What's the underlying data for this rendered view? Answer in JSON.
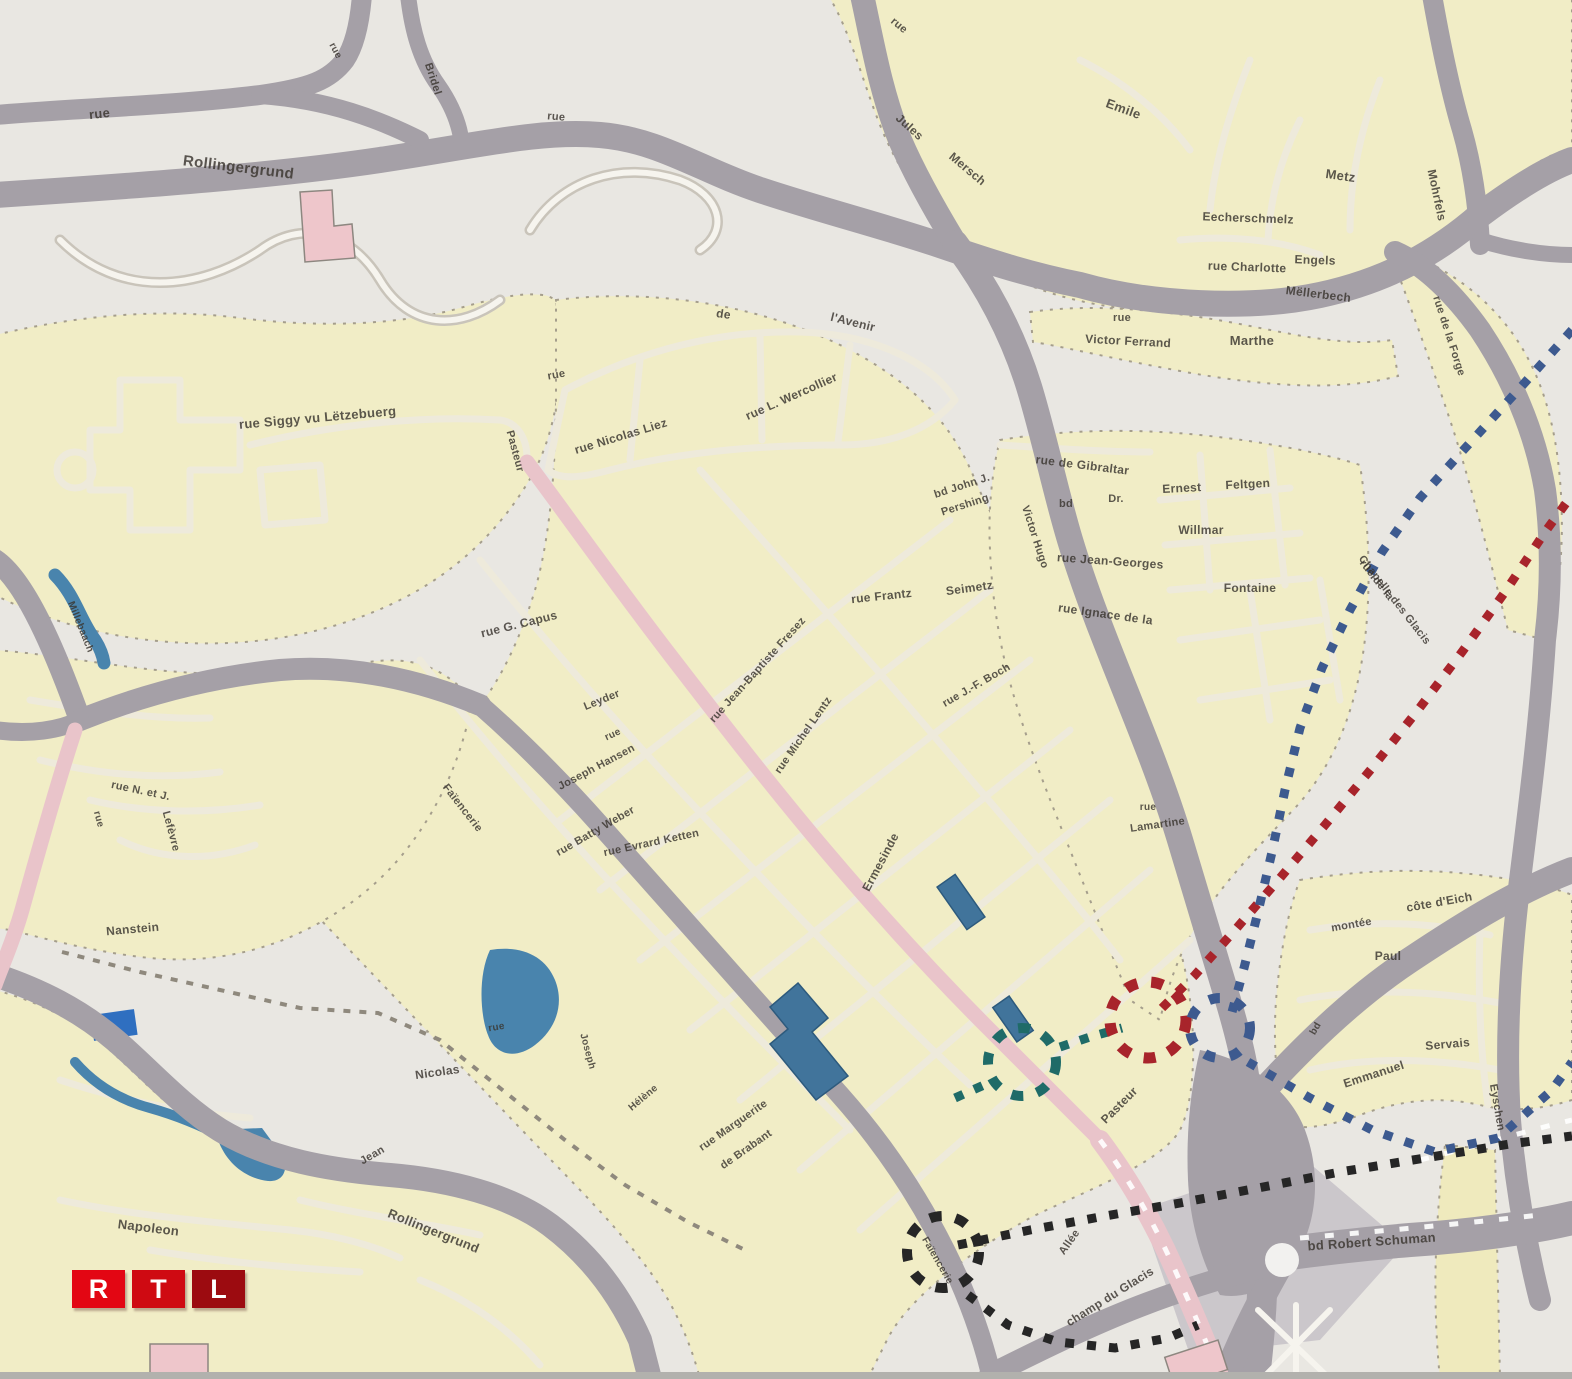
{
  "logo": {
    "letters": [
      "R",
      "T",
      "L"
    ],
    "colors": [
      "#e30613",
      "#cf0a12",
      "#9c0b10"
    ]
  },
  "palette": {
    "background": "#e9e7e2",
    "built_up": "#f1edc6",
    "gray_road": "#a5a0a7",
    "main_road_pink": "#e9c4ca",
    "water": "#4984ad",
    "glacis": "#cbc7cb",
    "route_red": "#a8242b",
    "route_blue": "#3d5a8f",
    "route_teal": "#1f6b68",
    "route_black": "#262626"
  },
  "map_labels": [
    {
      "text": "rue",
      "x": 100,
      "y": 118,
      "rot": -6,
      "size": 13
    },
    {
      "text": "Rollingergrund",
      "x": 238,
      "y": 172,
      "rot": 7,
      "size": 15
    },
    {
      "text": "rue",
      "x": 333,
      "y": 52,
      "rot": 62,
      "size": 10
    },
    {
      "text": "Bridel",
      "x": 430,
      "y": 80,
      "rot": 72,
      "size": 11
    },
    {
      "text": "rue",
      "x": 556,
      "y": 120,
      "rot": 5,
      "size": 11
    },
    {
      "text": "rue",
      "x": 897,
      "y": 28,
      "rot": 40,
      "size": 11
    },
    {
      "text": "Jules",
      "x": 907,
      "y": 130,
      "rot": 42,
      "size": 12
    },
    {
      "text": "Mersch",
      "x": 965,
      "y": 172,
      "rot": 40,
      "size": 12
    },
    {
      "text": "Emile",
      "x": 1122,
      "y": 113,
      "rot": 20,
      "size": 13
    },
    {
      "text": "Metz",
      "x": 1340,
      "y": 180,
      "rot": 8,
      "size": 13
    },
    {
      "text": "Eecherschmelz",
      "x": 1248,
      "y": 222,
      "rot": 2,
      "size": 12
    },
    {
      "text": "rue Charlotte",
      "x": 1247,
      "y": 271,
      "rot": 2,
      "size": 12
    },
    {
      "text": "Engels",
      "x": 1315,
      "y": 264,
      "rot": 2,
      "size": 12
    },
    {
      "text": "Mëllerbech",
      "x": 1318,
      "y": 298,
      "rot": 7,
      "size": 12
    },
    {
      "text": "rue",
      "x": 1122,
      "y": 321,
      "rot": 0,
      "size": 11
    },
    {
      "text": "Victor Ferrand",
      "x": 1128,
      "y": 345,
      "rot": 3,
      "size": 12
    },
    {
      "text": "Marthe",
      "x": 1252,
      "y": 345,
      "rot": 0,
      "size": 13
    },
    {
      "text": "Mohrfels",
      "x": 1433,
      "y": 196,
      "rot": 78,
      "size": 12
    },
    {
      "text": "rue de la Forge",
      "x": 1446,
      "y": 337,
      "rot": 72,
      "size": 11
    },
    {
      "text": "rue Siggy vu Lëtzebuerg",
      "x": 318,
      "y": 422,
      "rot": -5,
      "size": 13
    },
    {
      "text": "rue",
      "x": 557,
      "y": 378,
      "rot": -10,
      "size": 11
    },
    {
      "text": "de",
      "x": 723,
      "y": 318,
      "rot": 8,
      "size": 12
    },
    {
      "text": "l'Avenir",
      "x": 852,
      "y": 326,
      "rot": 14,
      "size": 12
    },
    {
      "text": "Pasteur",
      "x": 512,
      "y": 452,
      "rot": 75,
      "size": 11
    },
    {
      "text": "rue Nicolas Liez",
      "x": 622,
      "y": 440,
      "rot": -17,
      "size": 12
    },
    {
      "text": "rue L. Wercollier",
      "x": 793,
      "y": 400,
      "rot": -24,
      "size": 12
    },
    {
      "text": "bd John J.",
      "x": 963,
      "y": 489,
      "rot": -18,
      "size": 11
    },
    {
      "text": "Pershing",
      "x": 966,
      "y": 508,
      "rot": -18,
      "size": 11
    },
    {
      "text": "rue de Gibraltar",
      "x": 1082,
      "y": 469,
      "rot": 7,
      "size": 12
    },
    {
      "text": "bd",
      "x": 1066,
      "y": 507,
      "rot": 0,
      "size": 11
    },
    {
      "text": "Dr.",
      "x": 1116,
      "y": 502,
      "rot": 0,
      "size": 11
    },
    {
      "text": "Ernest",
      "x": 1182,
      "y": 492,
      "rot": -3,
      "size": 12
    },
    {
      "text": "Feltgen",
      "x": 1248,
      "y": 488,
      "rot": -3,
      "size": 12
    },
    {
      "text": "Willmar",
      "x": 1201,
      "y": 534,
      "rot": 0,
      "size": 12
    },
    {
      "text": "rue Jean-Georges",
      "x": 1110,
      "y": 565,
      "rot": 4,
      "size": 12
    },
    {
      "text": "rue Frantz",
      "x": 882,
      "y": 600,
      "rot": -6,
      "size": 12
    },
    {
      "text": "Seimetz",
      "x": 970,
      "y": 592,
      "rot": -8,
      "size": 12
    },
    {
      "text": "rue Ignace de la",
      "x": 1105,
      "y": 618,
      "rot": 8,
      "size": 12
    },
    {
      "text": "Fontaine",
      "x": 1250,
      "y": 592,
      "rot": 0,
      "size": 12
    },
    {
      "text": "Victor Hugo",
      "x": 1032,
      "y": 538,
      "rot": 72,
      "size": 11
    },
    {
      "text": "rue J.-F. Boch",
      "x": 978,
      "y": 688,
      "rot": -30,
      "size": 11
    },
    {
      "text": "Ermesinde",
      "x": 884,
      "y": 864,
      "rot": -62,
      "size": 12
    },
    {
      "text": "rue Michel Lentz",
      "x": 806,
      "y": 737,
      "rot": -55,
      "size": 11
    },
    {
      "text": "rue Jean-Baptiste Fresez",
      "x": 760,
      "y": 672,
      "rot": -48,
      "size": 11
    },
    {
      "text": "rue G. Capus",
      "x": 520,
      "y": 628,
      "rot": -14,
      "size": 12
    },
    {
      "text": "Leyder",
      "x": 603,
      "y": 703,
      "rot": -22,
      "size": 11
    },
    {
      "text": "rue",
      "x": 614,
      "y": 737,
      "rot": -25,
      "size": 10
    },
    {
      "text": "Joseph Hansen",
      "x": 598,
      "y": 770,
      "rot": -28,
      "size": 11
    },
    {
      "text": "rue Batty Weber",
      "x": 597,
      "y": 834,
      "rot": -30,
      "size": 11
    },
    {
      "text": "rue Evrard Ketten",
      "x": 652,
      "y": 846,
      "rot": -12,
      "size": 11
    },
    {
      "text": "rue",
      "x": 1148,
      "y": 810,
      "rot": 0,
      "size": 10
    },
    {
      "text": "Lamartine",
      "x": 1158,
      "y": 828,
      "rot": -8,
      "size": 11
    },
    {
      "text": "Pasteur",
      "x": 1122,
      "y": 1108,
      "rot": -45,
      "size": 12
    },
    {
      "text": "rue Marguerite",
      "x": 735,
      "y": 1128,
      "rot": -35,
      "size": 11
    },
    {
      "text": "de Brabant",
      "x": 748,
      "y": 1152,
      "rot": -35,
      "size": 11
    },
    {
      "text": "Nicolas",
      "x": 438,
      "y": 1076,
      "rot": -8,
      "size": 12
    },
    {
      "text": "Jean",
      "x": 374,
      "y": 1158,
      "rot": -30,
      "size": 11
    },
    {
      "text": "rue N. et J.",
      "x": 140,
      "y": 794,
      "rot": 12,
      "size": 11
    },
    {
      "text": "Lefèvre",
      "x": 168,
      "y": 832,
      "rot": 75,
      "size": 11
    },
    {
      "text": "rue",
      "x": 96,
      "y": 820,
      "rot": 75,
      "size": 10
    },
    {
      "text": "Nanstein",
      "x": 133,
      "y": 933,
      "rot": -5,
      "size": 12
    },
    {
      "text": "Faïencerie",
      "x": 460,
      "y": 810,
      "rot": 52,
      "size": 11
    },
    {
      "text": "Napoleon",
      "x": 148,
      "y": 1232,
      "rot": 7,
      "size": 13
    },
    {
      "text": "Rollingergrund",
      "x": 432,
      "y": 1235,
      "rot": 22,
      "size": 13
    },
    {
      "text": "Allée",
      "x": 1072,
      "y": 1244,
      "rot": -55,
      "size": 11
    },
    {
      "text": "champ du Glacis",
      "x": 1112,
      "y": 1300,
      "rot": -32,
      "size": 12
    },
    {
      "text": "bd Robert Schuman",
      "x": 1372,
      "y": 1246,
      "rot": -4,
      "size": 13
    },
    {
      "text": "Faïencerie",
      "x": 935,
      "y": 1262,
      "rot": 60,
      "size": 10
    },
    {
      "text": "montée",
      "x": 1352,
      "y": 928,
      "rot": -10,
      "size": 11
    },
    {
      "text": "côte d'Eich",
      "x": 1440,
      "y": 906,
      "rot": -10,
      "size": 12
    },
    {
      "text": "Paul",
      "x": 1388,
      "y": 960,
      "rot": 0,
      "size": 12
    },
    {
      "text": "Eyschen",
      "x": 1494,
      "y": 1108,
      "rot": 80,
      "size": 11
    },
    {
      "text": "Servais",
      "x": 1448,
      "y": 1048,
      "rot": -5,
      "size": 12
    },
    {
      "text": "Emmanuel",
      "x": 1375,
      "y": 1078,
      "rot": -18,
      "size": 12
    },
    {
      "text": "bd",
      "x": 1318,
      "y": 1030,
      "rot": -60,
      "size": 10
    },
    {
      "text": "rue de la",
      "x": 1374,
      "y": 582,
      "rot": 52,
      "size": 11
    },
    {
      "text": "Chapelle des Glacis",
      "x": 1392,
      "y": 602,
      "rot": 52,
      "size": 11
    },
    {
      "text": "Millebaach",
      "x": 78,
      "y": 628,
      "rot": 68,
      "size": 10,
      "fill": "#2d4f66"
    },
    {
      "text": "rue",
      "x": 497,
      "y": 1030,
      "rot": -10,
      "size": 10
    },
    {
      "text": "Joseph",
      "x": 585,
      "y": 1052,
      "rot": 75,
      "size": 10
    },
    {
      "text": "Hélène",
      "x": 645,
      "y": 1100,
      "rot": -40,
      "size": 10
    }
  ],
  "annotations": {
    "routes": [
      {
        "name": "route-red-dotted",
        "color": "#a8242b",
        "width": 9,
        "dash": "9 13",
        "points": [
          [
            1162,
            1008
          ],
          [
            1195,
            975
          ],
          [
            1235,
            930
          ],
          [
            1280,
            878
          ],
          [
            1325,
            825
          ],
          [
            1372,
            768
          ],
          [
            1418,
            710
          ],
          [
            1462,
            652
          ],
          [
            1505,
            592
          ],
          [
            1545,
            532
          ],
          [
            1572,
            495
          ]
        ]
      },
      {
        "name": "route-blue-dotted-north",
        "color": "#3d5a8f",
        "width": 9,
        "dash": "9 13",
        "points": [
          [
            1572,
            330
          ],
          [
            1520,
            388
          ],
          [
            1468,
            445
          ],
          [
            1420,
            498
          ],
          [
            1382,
            552
          ],
          [
            1350,
            610
          ],
          [
            1322,
            668
          ],
          [
            1300,
            728
          ],
          [
            1285,
            790
          ],
          [
            1272,
            852
          ],
          [
            1258,
            912
          ],
          [
            1244,
            968
          ],
          [
            1232,
            1012
          ]
        ]
      },
      {
        "name": "route-blue-dotted-southeast",
        "color": "#3d5a8f",
        "width": 9,
        "dash": "9 13",
        "points": [
          [
            1248,
            1062
          ],
          [
            1310,
            1098
          ],
          [
            1372,
            1130
          ],
          [
            1435,
            1152
          ],
          [
            1498,
            1138
          ],
          [
            1552,
            1090
          ],
          [
            1572,
            1062
          ]
        ]
      },
      {
        "name": "route-teal-tail",
        "color": "#1f6b68",
        "width": 9,
        "dash": "9 12",
        "points": [
          [
            955,
            1098
          ],
          [
            984,
            1085
          ]
        ]
      },
      {
        "name": "route-teal-link",
        "color": "#1f6b68",
        "width": 9,
        "dash": "9 12",
        "points": [
          [
            1060,
            1047
          ],
          [
            1090,
            1037
          ],
          [
            1122,
            1028
          ]
        ]
      },
      {
        "name": "route-black-dotted-main",
        "color": "#262626",
        "width": 9,
        "dash": "9 13",
        "points": [
          [
            958,
            1245
          ],
          [
            1030,
            1230
          ],
          [
            1105,
            1216
          ],
          [
            1180,
            1203
          ],
          [
            1258,
            1188
          ],
          [
            1340,
            1172
          ],
          [
            1425,
            1158
          ],
          [
            1510,
            1144
          ],
          [
            1572,
            1136
          ]
        ]
      },
      {
        "name": "route-black-dotted-south",
        "color": "#262626",
        "width": 9,
        "dash": "9 13",
        "points": [
          [
            968,
            1295
          ],
          [
            1008,
            1325
          ],
          [
            1058,
            1342
          ],
          [
            1115,
            1348
          ],
          [
            1168,
            1338
          ],
          [
            1198,
            1325
          ]
        ]
      },
      {
        "name": "footpath-dashed",
        "color": "#8f897d",
        "width": 4,
        "dash": "7 9",
        "points": [
          [
            62,
            952
          ],
          [
            140,
            972
          ],
          [
            220,
            990
          ],
          [
            300,
            1008
          ],
          [
            378,
            1013
          ],
          [
            440,
            1040
          ],
          [
            505,
            1092
          ],
          [
            565,
            1140
          ],
          [
            625,
            1185
          ],
          [
            688,
            1222
          ],
          [
            745,
            1250
          ]
        ]
      }
    ],
    "markers": [
      {
        "name": "marker-red-circle",
        "color": "#a8242b",
        "cx": 1148,
        "cy": 1020,
        "r": 38,
        "width": 11,
        "dash": "12 14"
      },
      {
        "name": "marker-teal-circle",
        "color": "#1f6b68",
        "cx": 1022,
        "cy": 1062,
        "r": 34,
        "width": 10,
        "dash": "12 14"
      },
      {
        "name": "marker-black-circle",
        "color": "#262626",
        "cx": 943,
        "cy": 1252,
        "r": 36,
        "width": 10,
        "dash": "12 14"
      },
      {
        "name": "marker-blue-cluster",
        "color": "#3d5a8f",
        "cx": 1220,
        "cy": 1028,
        "r": 30,
        "width": 10,
        "dash": "11 15"
      }
    ]
  }
}
